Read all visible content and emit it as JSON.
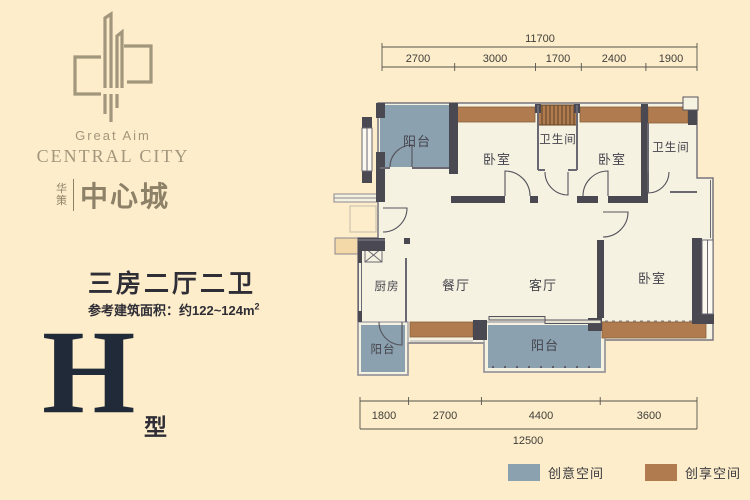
{
  "brand": {
    "logo_icon": "building-mark",
    "english_line1": "Great Aim",
    "english_line2": "CENTRAL CITY",
    "cn_small_top": "华",
    "cn_small_bottom": "策",
    "cn_name": "中心城"
  },
  "unit": {
    "layout_title": "三房二厅二卫",
    "area_text": "参考建筑面积：约122~124m",
    "area_sup": "2",
    "type_letter": "H",
    "type_suffix": "型"
  },
  "plan": {
    "rooms": [
      {
        "name": "balcony-top-left",
        "label": "阳台"
      },
      {
        "name": "bedroom-1",
        "label": "卧室"
      },
      {
        "name": "bathroom-1",
        "label": "卫生间"
      },
      {
        "name": "bedroom-2",
        "label": "卧室"
      },
      {
        "name": "bathroom-2",
        "label": "卫生间"
      },
      {
        "name": "kitchen",
        "label": "厨房"
      },
      {
        "name": "dining-room",
        "label": "餐厅"
      },
      {
        "name": "living-room",
        "label": "客厅"
      },
      {
        "name": "bedroom-3",
        "label": "卧室"
      },
      {
        "name": "balcony-kitchen",
        "label": "阳台"
      },
      {
        "name": "balcony-main",
        "label": "阳台"
      }
    ]
  },
  "dimensions": {
    "top": {
      "total": "11700",
      "segments": [
        "2700",
        "3000",
        "1700",
        "2400",
        "1900"
      ]
    },
    "bottom": {
      "total": "12500",
      "segments": [
        "1800",
        "2700",
        "4400",
        "3600"
      ]
    }
  },
  "legend": {
    "items": [
      {
        "label": "创意空间",
        "color": "#8ba1af"
      },
      {
        "label": "创享空间",
        "color": "#b07c4f"
      }
    ]
  },
  "watermark": "sina.com.cn",
  "colors": {
    "background": "#fdedca",
    "floor": "#f6f2e2",
    "wall": "#4a4851",
    "balcony_blue": "#8ba1af",
    "bay_brown": "#b07c4f",
    "brand_taupe": "#a2967c",
    "text_dark": "#2f2e36",
    "type_navy": "#202a38"
  }
}
